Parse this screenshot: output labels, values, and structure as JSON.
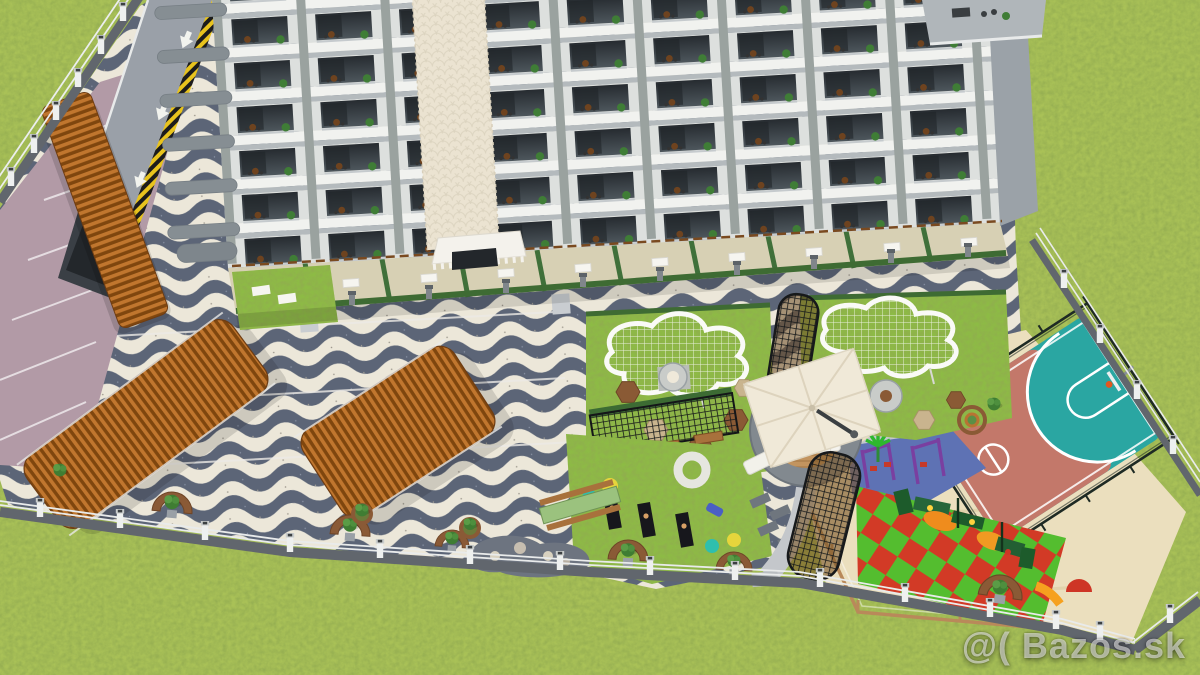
{
  "scene": {
    "title": "3D aerial render of an apartment complex with landscaped courtyard",
    "watermark": "@( Bazos.sk",
    "features": {
      "building": "multi-storey apartment block with balconies",
      "parking": "covered parking with wooden pergolas and underground garage ramp",
      "paving": "black-and-white wave mosaic promenade",
      "gardens": "lawn gardens with curved white mesh pergolas and seating decks",
      "plaza": "circular lounge plaza with cantilever umbrella and sofa",
      "sports": "fenced basketball half court",
      "playground": "children playground with slides, swings and climbing frames",
      "wellness": "outdoor yoga and fitness lawn",
      "perimeter": "white fence with lamp posts around the plot"
    }
  },
  "colors": {
    "grass": "#a9c157",
    "lawn": "#8dbb45",
    "wave_dark": "#5c6577",
    "wave_light": "#ece7d9",
    "parking": "#b29aa6",
    "wood_light": "#c0762e",
    "wood_dark": "#7f460e",
    "sand": "#ebdfbe",
    "court_salmon": "#c3786a",
    "court_teal": "#2aa6a2",
    "checker_red": "#d23a26",
    "checker_green": "#54bd2f",
    "rubber_blue": "#5e72b4",
    "umbrella": "#f0e9d8",
    "fence_wall": "#61666d",
    "path": "#c4c7cb",
    "building_facade": "#dde0de",
    "building_slab": "#f1f2ef",
    "cream_wall": "#ebe3d1",
    "hedge": "#3e6b33",
    "planter": "#8a5a36"
  }
}
